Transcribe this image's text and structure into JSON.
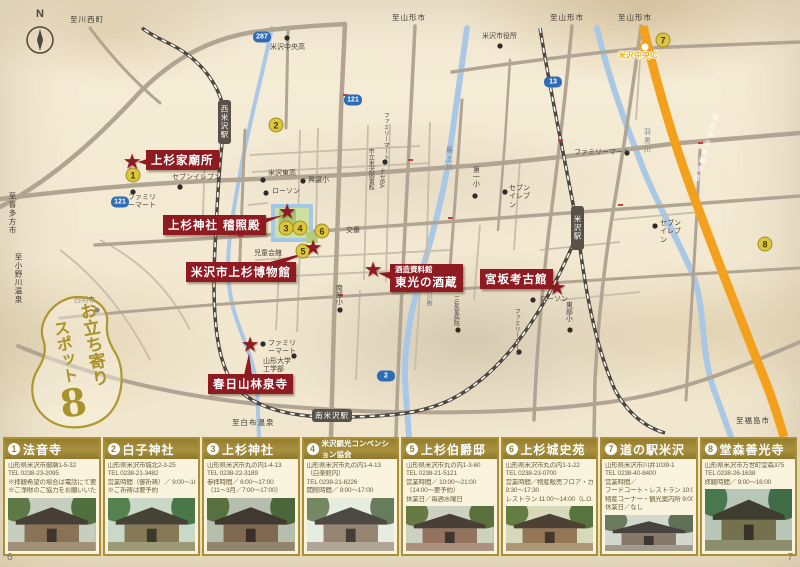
{
  "compass": {
    "north": "N"
  },
  "badge": {
    "line1": "お立ち寄り",
    "line2": "スポット",
    "number": "8"
  },
  "page": {
    "left_number": "6",
    "right_number": "7"
  },
  "colors": {
    "accent_red": "#8e1b21",
    "gold": "#a8922f",
    "card_header_gold": "#93803a",
    "expressway_orange": "#f3a11c",
    "river_blue": "#a9c8e5",
    "road_grey": "#b2a493",
    "spot_marker_yellow": "#dcc63d",
    "route_shield_blue": "#2e6cb5",
    "ic_yellow": "#e8b414"
  },
  "map": {
    "landmarks": [
      {
        "title": "上杉家廟所"
      },
      {
        "title": "上杉神社 稽照殿"
      },
      {
        "title": "米沢市上杉博物館"
      },
      {
        "subtitle": "酒造資料館",
        "title": "東光の酒蔵"
      },
      {
        "title": "宮坂考古館"
      },
      {
        "title": "春日山林泉寺"
      }
    ],
    "spot_markers": [
      {
        "number": "1"
      },
      {
        "number": "2"
      },
      {
        "number": "3"
      },
      {
        "number": "4"
      },
      {
        "number": "5"
      },
      {
        "number": "6"
      },
      {
        "number": "7"
      },
      {
        "number": "8"
      }
    ],
    "route_shields": [
      {
        "number": "287"
      },
      {
        "number": "13"
      },
      {
        "number": "121"
      },
      {
        "number": "121"
      },
      {
        "number": "2"
      }
    ],
    "stations": [
      {
        "name": "西米沢駅"
      },
      {
        "name": "米沢駅"
      },
      {
        "name": "南米沢駅"
      }
    ],
    "expressway_label": "東北中央自動車道",
    "ic_label": "米沢中央IC",
    "labels": [
      {
        "text": "至川西町"
      },
      {
        "text": "至山形市"
      },
      {
        "text": "至山形市"
      },
      {
        "text": "至山形市"
      },
      {
        "text": "羽黒川"
      },
      {
        "text": "最上川"
      },
      {
        "text": "松川河川敷"
      },
      {
        "text": "至喜多方市"
      },
      {
        "text": "至小野川温泉"
      },
      {
        "text": "至白布温泉"
      },
      {
        "text": "至福島市"
      },
      {
        "text": "米沢市役所"
      },
      {
        "text": "米沢中央高"
      },
      {
        "text": "米沢東高"
      },
      {
        "text": "興譲小"
      },
      {
        "text": "第一小"
      },
      {
        "text": "東部小"
      },
      {
        "text": "南部小"
      },
      {
        "text": "西明寺"
      },
      {
        "text": "交番"
      },
      {
        "text": "児童会館"
      },
      {
        "text": "山形大学工学部"
      },
      {
        "text": "ファミリーマート"
      },
      {
        "text": "セブンイレブン"
      },
      {
        "text": "ファミリーマート"
      },
      {
        "text": "ローソン"
      },
      {
        "text": "ローソン"
      },
      {
        "text": "ファミリーマート"
      },
      {
        "text": "セブンイレブン"
      },
      {
        "text": "セブンイレブン"
      },
      {
        "text": "市立米沢図書館"
      },
      {
        "text": "ナセBA"
      },
      {
        "text": "三友堂病院"
      },
      {
        "text": "ファミリーマート"
      },
      {
        "text": "ファミリーマート"
      }
    ]
  },
  "cards": [
    {
      "number": "1",
      "title": "法音寺",
      "lines": [
        "山形県米沢市御廟1-5-32",
        "TEL 0238-23-2095",
        "※拝観希望の場合は電話にて要予約",
        "※ご浄財のご協力をお願いいたします"
      ]
    },
    {
      "number": "2",
      "title": "白子神社",
      "lines": [
        "山形県米沢市城北2-3-25",
        "TEL 0238-21-3482",
        "営業時間（御祈祷）／ 9:00～16:00",
        "※ご祈祷は要予約"
      ]
    },
    {
      "number": "3",
      "title": "上杉神社",
      "lines": [
        "山形県米沢市丸の内1-4-13",
        "TEL 0238-22-3189",
        "参拝時間／ 6:00～17:00",
        "（11～3月／7:00～17:00）"
      ]
    },
    {
      "number": "4",
      "title": "米沢観光コンベンション協会",
      "lines": [
        "山形県米沢市丸の内1-4-13",
        "（白楽館内）",
        "TEL 0238-21-6226",
        "開館時間／ 9:00～17:00"
      ]
    },
    {
      "number": "5",
      "title": "上杉伯爵邸",
      "lines": [
        "山形県米沢市丸の内1-3-60",
        "TEL 0238-21-5121",
        "営業時間／ 10:00～21:00",
        "（14:00～要予約）",
        "休業日／毎週水曜日"
      ]
    },
    {
      "number": "6",
      "title": "上杉城史苑",
      "lines": [
        "山形県米沢市丸の内1-1-22",
        "TEL 0238-23-0700",
        "営業時間／物産販売フロア・カフェ",
        "9:30～17:30",
        "レストラン 11:00～14:00（L.O.）"
      ]
    },
    {
      "number": "7",
      "title": "道の駅米沢",
      "lines": [
        "山形県米沢市川井1039-1",
        "TEL 0238-40-8400",
        "営業時間／",
        "フードコート・レストラン 10:00～18:00",
        "物産コーナー・観光案内所 9:00～18:30",
        "休業日／なし"
      ]
    },
    {
      "number": "8",
      "title": "堂森善光寺",
      "lines": [
        "山形県米沢市万世町堂森375",
        "TEL 0238-26-1638",
        "拝観時間／ 9:00～16:00"
      ]
    }
  ]
}
